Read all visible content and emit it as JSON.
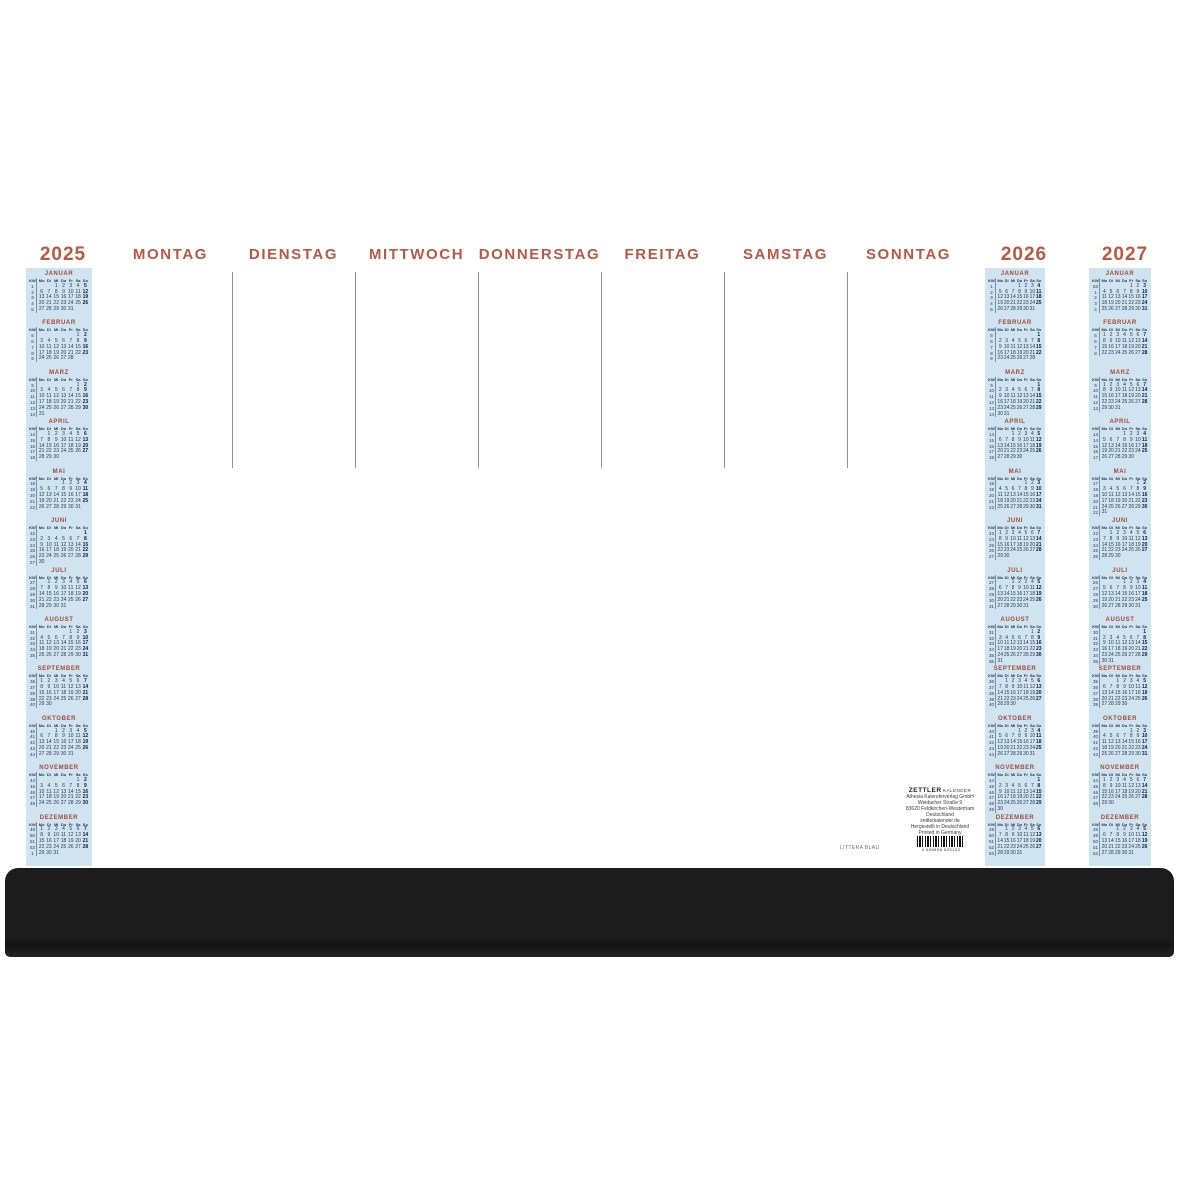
{
  "product": {
    "kind": "desk-pad-weekly-planner",
    "accent_color": "#b85742",
    "strip_bg": "#cfe3f0",
    "rail_color": "#1c1c1c"
  },
  "weekday_headers": [
    "MONTAG",
    "DIENSTAG",
    "MITTWOCH",
    "DONNERSTAG",
    "FREITAG",
    "SAMSTAG",
    "SONNTAG"
  ],
  "mini_weekdays": [
    "KW",
    "Mo",
    "Di",
    "Mi",
    "Do",
    "Fr",
    "Sa",
    "So"
  ],
  "years": [
    {
      "label": "2025",
      "months": [
        {
          "name": "JANUAR",
          "first_dow": 2,
          "days": 31,
          "weeks": [
            1,
            2,
            3,
            4,
            5
          ]
        },
        {
          "name": "FEBRUAR",
          "first_dow": 5,
          "days": 28,
          "weeks": [
            5,
            6,
            7,
            8,
            9
          ]
        },
        {
          "name": "MÄRZ",
          "first_dow": 5,
          "days": 31,
          "weeks": [
            9,
            10,
            11,
            12,
            13,
            14
          ]
        },
        {
          "name": "APRIL",
          "first_dow": 1,
          "days": 30,
          "weeks": [
            14,
            15,
            16,
            17,
            18
          ]
        },
        {
          "name": "MAI",
          "first_dow": 3,
          "days": 31,
          "weeks": [
            18,
            19,
            20,
            21,
            22
          ]
        },
        {
          "name": "JUNI",
          "first_dow": 6,
          "days": 30,
          "weeks": [
            22,
            23,
            24,
            25,
            26,
            27
          ]
        },
        {
          "name": "JULI",
          "first_dow": 1,
          "days": 31,
          "weeks": [
            27,
            28,
            29,
            30,
            31
          ]
        },
        {
          "name": "AUGUST",
          "first_dow": 4,
          "days": 31,
          "weeks": [
            31,
            32,
            33,
            34,
            35
          ]
        },
        {
          "name": "SEPTEMBER",
          "first_dow": 0,
          "days": 30,
          "weeks": [
            36,
            37,
            38,
            39,
            40
          ]
        },
        {
          "name": "OKTOBER",
          "first_dow": 2,
          "days": 31,
          "weeks": [
            40,
            41,
            42,
            43,
            44
          ]
        },
        {
          "name": "NOVEMBER",
          "first_dow": 5,
          "days": 30,
          "weeks": [
            44,
            45,
            46,
            47,
            48
          ]
        },
        {
          "name": "DEZEMBER",
          "first_dow": 0,
          "days": 31,
          "weeks": [
            49,
            50,
            51,
            52,
            1
          ]
        }
      ]
    },
    {
      "label": "2026",
      "months": [
        {
          "name": "JANUAR",
          "first_dow": 3,
          "days": 31,
          "weeks": [
            1,
            2,
            3,
            4,
            5
          ]
        },
        {
          "name": "FEBRUAR",
          "first_dow": 6,
          "days": 28,
          "weeks": [
            5,
            6,
            7,
            8,
            9
          ]
        },
        {
          "name": "MÄRZ",
          "first_dow": 6,
          "days": 31,
          "weeks": [
            9,
            10,
            11,
            12,
            13,
            14
          ]
        },
        {
          "name": "APRIL",
          "first_dow": 2,
          "days": 30,
          "weeks": [
            14,
            15,
            16,
            17,
            18
          ]
        },
        {
          "name": "MAI",
          "first_dow": 4,
          "days": 31,
          "weeks": [
            18,
            19,
            20,
            21,
            22
          ]
        },
        {
          "name": "JUNI",
          "first_dow": 0,
          "days": 30,
          "weeks": [
            23,
            24,
            25,
            26,
            27
          ]
        },
        {
          "name": "JULI",
          "first_dow": 2,
          "days": 31,
          "weeks": [
            27,
            28,
            29,
            30,
            31
          ]
        },
        {
          "name": "AUGUST",
          "first_dow": 5,
          "days": 31,
          "weeks": [
            31,
            32,
            33,
            34,
            35,
            36
          ]
        },
        {
          "name": "SEPTEMBER",
          "first_dow": 1,
          "days": 30,
          "weeks": [
            36,
            37,
            38,
            39,
            40
          ]
        },
        {
          "name": "OKTOBER",
          "first_dow": 3,
          "days": 31,
          "weeks": [
            40,
            41,
            42,
            43,
            44
          ]
        },
        {
          "name": "NOVEMBER",
          "first_dow": 6,
          "days": 30,
          "weeks": [
            44,
            45,
            46,
            47,
            48,
            49
          ]
        },
        {
          "name": "DEZEMBER",
          "first_dow": 1,
          "days": 31,
          "weeks": [
            49,
            50,
            51,
            52,
            53
          ]
        }
      ]
    },
    {
      "label": "2027",
      "months": [
        {
          "name": "JANUAR",
          "first_dow": 4,
          "days": 31,
          "weeks": [
            53,
            1,
            2,
            3,
            4
          ]
        },
        {
          "name": "FEBRUAR",
          "first_dow": 0,
          "days": 28,
          "weeks": [
            5,
            6,
            7,
            8
          ]
        },
        {
          "name": "MÄRZ",
          "first_dow": 0,
          "days": 31,
          "weeks": [
            9,
            10,
            11,
            12,
            13
          ]
        },
        {
          "name": "APRIL",
          "first_dow": 3,
          "days": 30,
          "weeks": [
            13,
            14,
            15,
            16,
            17
          ]
        },
        {
          "name": "MAI",
          "first_dow": 5,
          "days": 31,
          "weeks": [
            17,
            18,
            19,
            20,
            21,
            22
          ]
        },
        {
          "name": "JUNI",
          "first_dow": 1,
          "days": 30,
          "weeks": [
            22,
            23,
            24,
            25,
            26
          ]
        },
        {
          "name": "JULI",
          "first_dow": 3,
          "days": 31,
          "weeks": [
            26,
            27,
            28,
            29,
            30
          ]
        },
        {
          "name": "AUGUST",
          "first_dow": 6,
          "days": 31,
          "weeks": [
            30,
            31,
            32,
            33,
            34,
            35
          ]
        },
        {
          "name": "SEPTEMBER",
          "first_dow": 2,
          "days": 30,
          "weeks": [
            35,
            36,
            37,
            38,
            39
          ]
        },
        {
          "name": "OKTOBER",
          "first_dow": 4,
          "days": 31,
          "weeks": [
            39,
            40,
            41,
            42,
            43
          ]
        },
        {
          "name": "NOVEMBER",
          "first_dow": 0,
          "days": 30,
          "weeks": [
            44,
            45,
            46,
            47,
            48
          ]
        },
        {
          "name": "DEZEMBER",
          "first_dow": 2,
          "days": 31,
          "weeks": [
            48,
            49,
            50,
            51,
            52
          ]
        }
      ]
    }
  ],
  "imprint": {
    "brand": "ZETTLER",
    "brand_suffix": "KALENDER",
    "lines": [
      "Athesia Kalenderverlag GmbH",
      "Weidacher Straße 9",
      "83620 Feldkirchen-Westerham",
      "Deutschland",
      "zettlerkalender.de",
      "Hergestellt in Deutschland",
      "Printed in Germany"
    ]
  },
  "article_label": "LITTERA BLAU",
  "barcode_digits": "4 006928 023103"
}
